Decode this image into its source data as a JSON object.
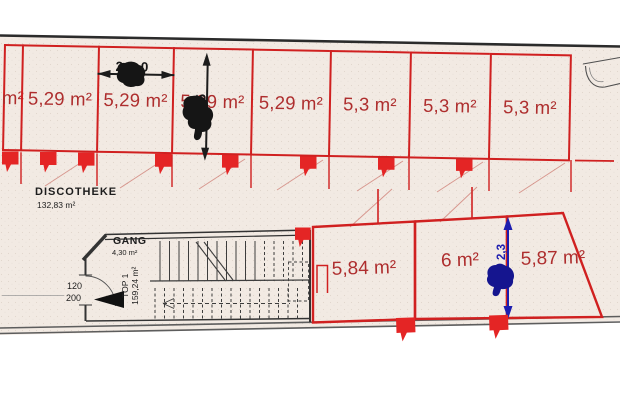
{
  "plan": {
    "colors": {
      "red": "#d02020",
      "red_text": "#ae2e2e",
      "blue": "#1d1daf",
      "paper": "#f2eae3",
      "ink": "#2b2b2b"
    },
    "top_row": {
      "cells": [
        {
          "label": "m²"
        },
        {
          "label": "5,29 m²"
        },
        {
          "label": "5,29 m²"
        },
        {
          "label": "5,29 m²"
        },
        {
          "label": "5,29 m²"
        },
        {
          "label": "5,3 m²"
        },
        {
          "label": "5,3 m²"
        },
        {
          "label": "5,3 m²"
        }
      ]
    },
    "bottom_row": {
      "cells": [
        {
          "label": "5,84 m²"
        },
        {
          "label": "6 m²"
        },
        {
          "label": "5,87 m²"
        }
      ]
    },
    "dimensions": {
      "cell_width": "2,0",
      "cell_depth": "2,65",
      "right_cell_depth": "2,3"
    },
    "rooms": {
      "discotheke": {
        "name": "DISCOTHEKE",
        "area": "132,83 m²"
      },
      "gang": {
        "name": "GANG",
        "area": "4,30 m²"
      },
      "top1": {
        "name": "TOP 1",
        "area": "159,24 m²"
      }
    },
    "door": {
      "width": "120",
      "height": "200"
    }
  }
}
